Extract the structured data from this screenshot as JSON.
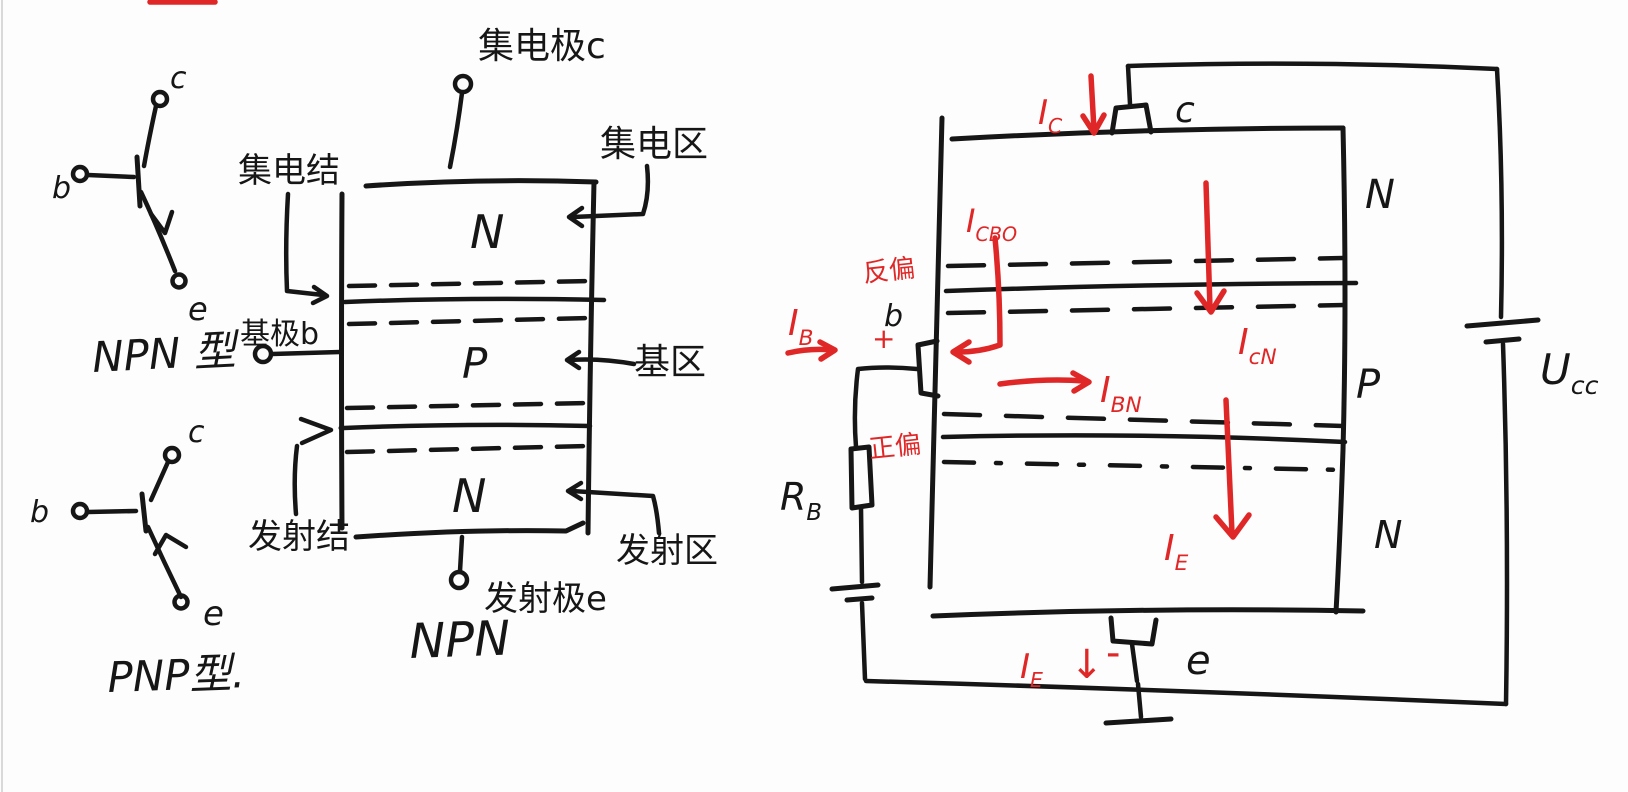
{
  "canvas": {
    "bg": "#fdfdfd",
    "ink": "#161616",
    "red": "#e02727",
    "edge_line": "#d9d9d9"
  },
  "symbols_panel": {
    "npn": {
      "c": "c",
      "b": "b",
      "e": "e",
      "caption": "NPN 型"
    },
    "pnp": {
      "c": "c",
      "b": "b",
      "e": "e",
      "caption": "PNP型."
    }
  },
  "structure": {
    "collector_terminal": "集电极c",
    "collector_junction": "集电结",
    "collector_region": "集电区",
    "base_terminal": "基极b",
    "base_region": "基区",
    "emitter_junction": "发射结",
    "emitter_region": "发射区",
    "emitter_terminal": "发射极e",
    "region_top": "N",
    "region_mid": "P",
    "region_bottom": "N",
    "caption": "NPN"
  },
  "circuit": {
    "ic": {
      "m": "I",
      "s": "C"
    },
    "c": "c",
    "icbo": {
      "m": "I",
      "s": "CBO"
    },
    "reverse_bias": "反偏",
    "b": "b",
    "plus": "+",
    "ib": {
      "m": "I",
      "s": "B"
    },
    "forward_bias": "正偏",
    "rb": {
      "m": "R",
      "s": "B"
    },
    "ibn": {
      "m": "I",
      "s": "BN"
    },
    "icn": {
      "m": "I",
      "s": "cN"
    },
    "ie": {
      "m": "I",
      "s": "E"
    },
    "region_top": "N",
    "region_mid": "P",
    "region_bottom": "N",
    "ie_bottom": {
      "m": "I",
      "s": "E"
    },
    "down_arrow": "↓",
    "minus": "-",
    "e": "e",
    "ucc": {
      "m": "U",
      "s": "cc"
    }
  }
}
